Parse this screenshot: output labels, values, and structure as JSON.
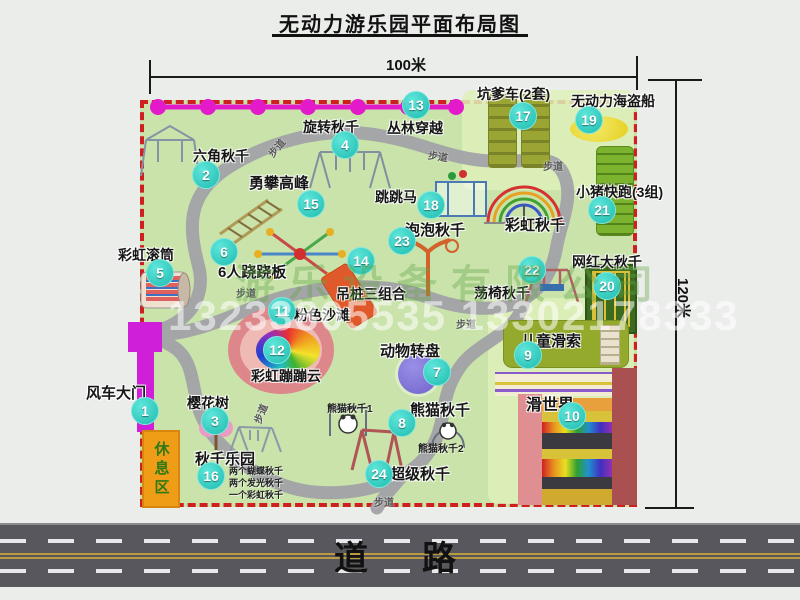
{
  "title": "无动力游乐园平面布局图",
  "dimensions": {
    "top": "100米",
    "right": "120米"
  },
  "road": {
    "label": "道　路"
  },
  "rest_area": {
    "label": "休息区"
  },
  "watermark": {
    "company": "游乐设备有限公司",
    "phone": "13233805535 13302178333"
  },
  "walkway": {
    "label": "步道",
    "positions": [
      [
        266,
        140,
        -50
      ],
      [
        428,
        148,
        8
      ],
      [
        543,
        158,
        0
      ],
      [
        236,
        285,
        0
      ],
      [
        456,
        316,
        0
      ],
      [
        250,
        406,
        -68
      ],
      [
        374,
        494,
        0
      ]
    ]
  },
  "colors": {
    "park_green": "#c9e3ab",
    "border_red": "#cf2020",
    "badge_cyan": "#1fbcb0",
    "chain_magenta": "#e31ac9",
    "gate_magenta": "#cf1fd8",
    "rest_orange": "#ef9c16",
    "road_gray": "#57575d"
  },
  "attractions": [
    {
      "num": "1",
      "name": "风车大门",
      "badge": [
        145,
        411
      ],
      "label": [
        86,
        382
      ],
      "size": 15
    },
    {
      "num": "2",
      "name": "六角秋千",
      "badge": [
        206,
        175
      ],
      "label": [
        193,
        146
      ],
      "size": 14
    },
    {
      "num": "3",
      "name": "樱花树",
      "badge": [
        215,
        421
      ],
      "label": [
        187,
        393
      ],
      "size": 14
    },
    {
      "num": "4",
      "name": "旋转秋千",
      "badge": [
        345,
        145
      ],
      "label": [
        303,
        117
      ],
      "size": 14
    },
    {
      "num": "5",
      "name": "彩虹滚筒",
      "badge": [
        160,
        273
      ],
      "label": [
        118,
        245
      ],
      "size": 14
    },
    {
      "num": "6",
      "name": "6人跷跷板",
      "badge": [
        224,
        252
      ],
      "label": [
        218,
        261
      ],
      "size": 15
    },
    {
      "num": "7",
      "name": "动物转盘",
      "badge": [
        437,
        372
      ],
      "label": [
        380,
        340
      ],
      "size": 15
    },
    {
      "num": "8",
      "name": "熊猫秋千",
      "badge": [
        402,
        423
      ],
      "label": [
        410,
        399
      ],
      "size": 15,
      "subs": [
        {
          "text": "熊猫秋千1",
          "pos": [
            327,
            400
          ],
          "size": 10
        },
        {
          "text": "熊猫秋千2",
          "pos": [
            418,
            440
          ],
          "size": 10
        }
      ]
    },
    {
      "num": "9",
      "name": "儿童滑索",
      "badge": [
        528,
        355
      ],
      "label": [
        521,
        330
      ],
      "size": 15
    },
    {
      "num": "10",
      "name": "滑世界",
      "badge": [
        572,
        416
      ],
      "label": [
        526,
        391
      ],
      "size": 16
    },
    {
      "num": "11",
      "name": "粉色沙滩",
      "badge": [
        282,
        311
      ],
      "label": [
        294,
        305
      ],
      "size": 14
    },
    {
      "num": "12",
      "name": "彩虹蹦蹦云",
      "badge": [
        277,
        350
      ],
      "label": [
        251,
        366
      ],
      "size": 14
    },
    {
      "num": "13",
      "name": "丛林穿越",
      "badge": [
        416,
        105
      ],
      "label": [
        387,
        118
      ],
      "size": 14
    },
    {
      "num": "14",
      "name": "吊桩三组合",
      "badge": [
        361,
        261
      ],
      "label": [
        336,
        284
      ],
      "size": 14
    },
    {
      "num": "15",
      "name": "勇攀高峰",
      "badge": [
        311,
        204
      ],
      "label": [
        249,
        172
      ],
      "size": 15
    },
    {
      "num": "16",
      "name": "秋千乐园",
      "badge": [
        211,
        476
      ],
      "label": [
        195,
        448
      ],
      "size": 15,
      "subs": [
        {
          "text": "两个蝴蝶秋千",
          "pos": [
            229,
            464
          ],
          "size": 9
        },
        {
          "text": "两个发光秋千",
          "pos": [
            229,
            476
          ],
          "size": 9
        },
        {
          "text": "一个彩虹秋千",
          "pos": [
            229,
            488
          ],
          "size": 9
        }
      ]
    },
    {
      "num": "17",
      "name": "坑爹车(2套)",
      "badge": [
        523,
        116
      ],
      "label": [
        477,
        84
      ],
      "size": 14
    },
    {
      "num": "18",
      "name": "跳跳马",
      "badge": [
        431,
        205
      ],
      "label": [
        375,
        187
      ],
      "size": 14
    },
    {
      "num": "19",
      "name": "无动力海盗船",
      "badge": [
        589,
        120
      ],
      "label": [
        571,
        91
      ],
      "size": 14
    },
    {
      "num": "20",
      "name": "网红大秋千",
      "badge": [
        607,
        286
      ],
      "label": [
        572,
        252
      ],
      "size": 14
    },
    {
      "num": "21",
      "name": "小猪快跑(3组)",
      "badge": [
        602,
        210
      ],
      "label": [
        576,
        182
      ],
      "size": 14
    },
    {
      "num": "22",
      "name": "荡椅秋千",
      "badge": [
        532,
        270
      ],
      "label": [
        474,
        283
      ],
      "size": 14
    },
    {
      "num": "23",
      "name": "泡泡秋千",
      "badge": [
        402,
        241
      ],
      "label": [
        405,
        219
      ],
      "size": 15
    },
    {
      "num": "24",
      "name": "超级秋千",
      "badge": [
        379,
        474
      ],
      "label": [
        390,
        463
      ],
      "size": 15
    },
    {
      "num": "",
      "name": "彩虹秋千",
      "label": [
        505,
        214
      ],
      "size": 15
    }
  ],
  "slide_world_strips": [
    {
      "top": 398,
      "height": 13,
      "bg": "#e8a03c"
    },
    {
      "top": 411,
      "height": 11,
      "bg": "#d8c23a"
    },
    {
      "top": 422,
      "height": 11,
      "bg": "rainbow"
    },
    {
      "top": 433,
      "height": 16,
      "bg": "#3a3a40"
    },
    {
      "top": 449,
      "height": 10,
      "bg": "#d8c23a"
    },
    {
      "top": 459,
      "height": 18,
      "bg": "rainbow"
    },
    {
      "top": 477,
      "height": 12,
      "bg": "#3a3a40"
    },
    {
      "top": 489,
      "height": 16,
      "bg": "#d0aa2e"
    }
  ]
}
